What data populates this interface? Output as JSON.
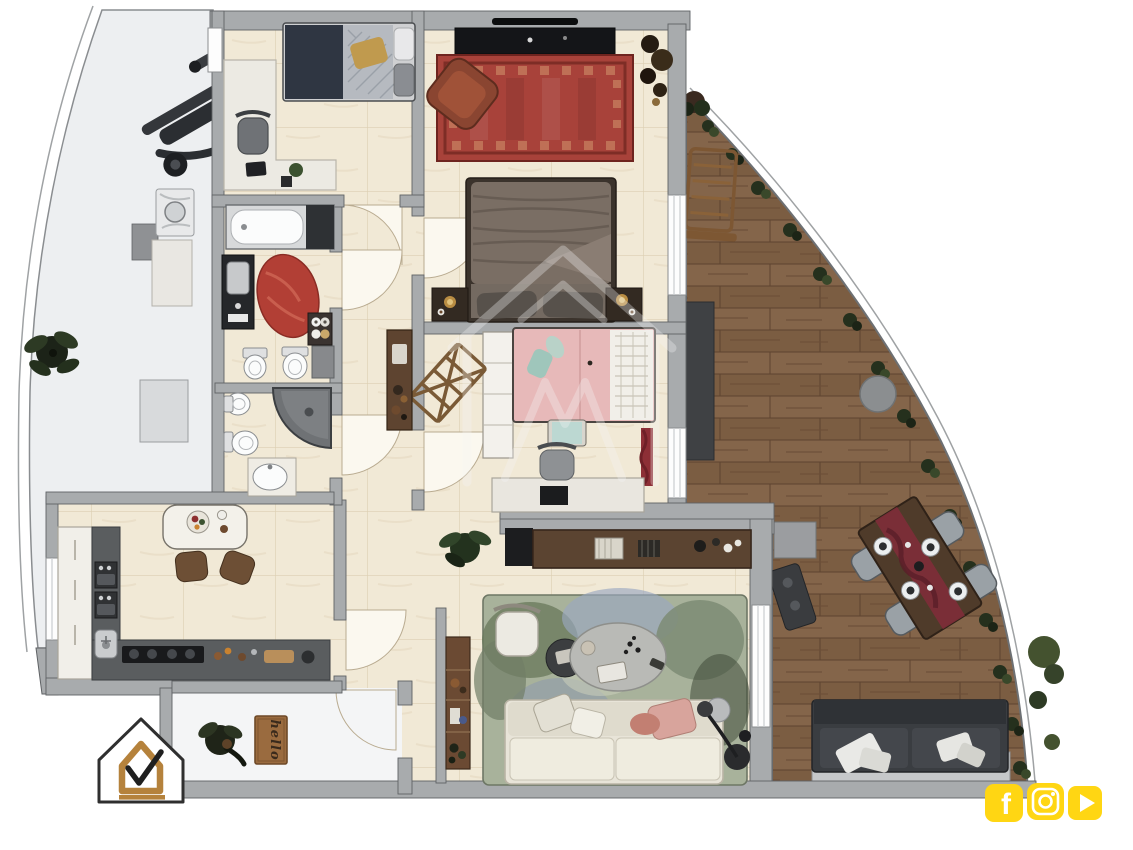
{
  "meta": {
    "title": "apartment-floor-plan-render"
  },
  "palette": {
    "wall_gray": "#a8abad",
    "wall_edge": "#5f6265",
    "floor_tile": "#f1e9d6",
    "tile_line": "#dccfb2",
    "balcony_floor": "#edeff1",
    "terrace_wood": "#84654a",
    "terrace_wood_dark": "#6a4d36",
    "rug_red": "#a8423a",
    "bath_rug_red": "#b23f35",
    "kids_pink": "#e7b9b9",
    "living_rug_green": "#a8b29b",
    "sofa_cream": "#e8e4d8",
    "outdoor_sofa": "#3a3d41",
    "accent_yellow": "#ffd613",
    "logo_gold": "#b5823c",
    "plant_green": "#2d3a24",
    "watermark_white": "#f5f5f5"
  },
  "branding": {
    "logo": {
      "name": "house-check-logo",
      "colors": {
        "outline": "#2f2f2f",
        "inner_house": "#b5823c",
        "check": "#1f1f1f",
        "underline": "#b5823c"
      }
    },
    "watermark": {
      "name": "house-watermark",
      "opacity": 0.32
    }
  },
  "social": {
    "color": "#ffd613",
    "glyph_color": "#ffffff",
    "facebook_glyph": "f",
    "icons": [
      {
        "name": "facebook-icon"
      },
      {
        "name": "instagram-icon"
      },
      {
        "name": "youtube-icon"
      }
    ]
  },
  "entrance": {
    "doormat_text": "hello"
  },
  "rooms": [
    {
      "name": "bedroom-2",
      "furniture": [
        "single-bed",
        "gold-pillow",
        "desk",
        "office-chair",
        "laptop",
        "plant"
      ]
    },
    {
      "name": "master-bedroom",
      "furniture": [
        "tv-console",
        "tv",
        "red-oriental-rug",
        "leather-armchair",
        "double-bed",
        "nightstand-left",
        "nightstand-right",
        "corner-plant"
      ]
    },
    {
      "name": "kids-bedroom",
      "furniture": [
        "pink-single-bed",
        "quilted-headboard",
        "teal-bench",
        "shelf-unit",
        "clothes-drying-rack",
        "desk",
        "desk-chair",
        "laptop",
        "red-curtain"
      ]
    },
    {
      "name": "bathroom-1",
      "furniture": [
        "bathtub",
        "dark-vanity-sink",
        "red-oval-rug",
        "towel-shelf",
        "bidet",
        "toilet",
        "gray-cabinet"
      ]
    },
    {
      "name": "bathroom-2",
      "furniture": [
        "bidet",
        "toilet",
        "corner-shower",
        "sink-counter"
      ]
    },
    {
      "name": "hallway",
      "furniture": [
        "console-table"
      ]
    },
    {
      "name": "kitchen",
      "furniture": [
        "tall-white-unit",
        "double-oven",
        "corner-sink",
        "cooktop",
        "l-counter",
        "dining-table",
        "dining-chair",
        "dining-chair"
      ]
    },
    {
      "name": "living-room",
      "furniture": [
        "sideboard",
        "black-cabinet",
        "plant",
        "abstract-area-rug",
        "white-armchair",
        "oval-coffee-table",
        "round-side-table",
        "cream-sofa",
        "pink-pillows",
        "floor-lamp",
        "narrow-shelf"
      ]
    },
    {
      "name": "entrance-hall",
      "furniture": [
        "plant",
        "hello-doormat"
      ]
    },
    {
      "name": "balcony-left",
      "furniture": [
        "exercise-machine",
        "plant",
        "washing-machine",
        "gray-cabinet",
        "storage-cabinet"
      ]
    },
    {
      "name": "terrace-right",
      "furniture": [
        "sun-lounger",
        "dark-floor-mat",
        "round-gray-table",
        "dining-table-set",
        "outdoor-chairs",
        "outdoor-sofa",
        "bbq-grill",
        "railing-plants",
        "corner-bushes"
      ]
    }
  ]
}
